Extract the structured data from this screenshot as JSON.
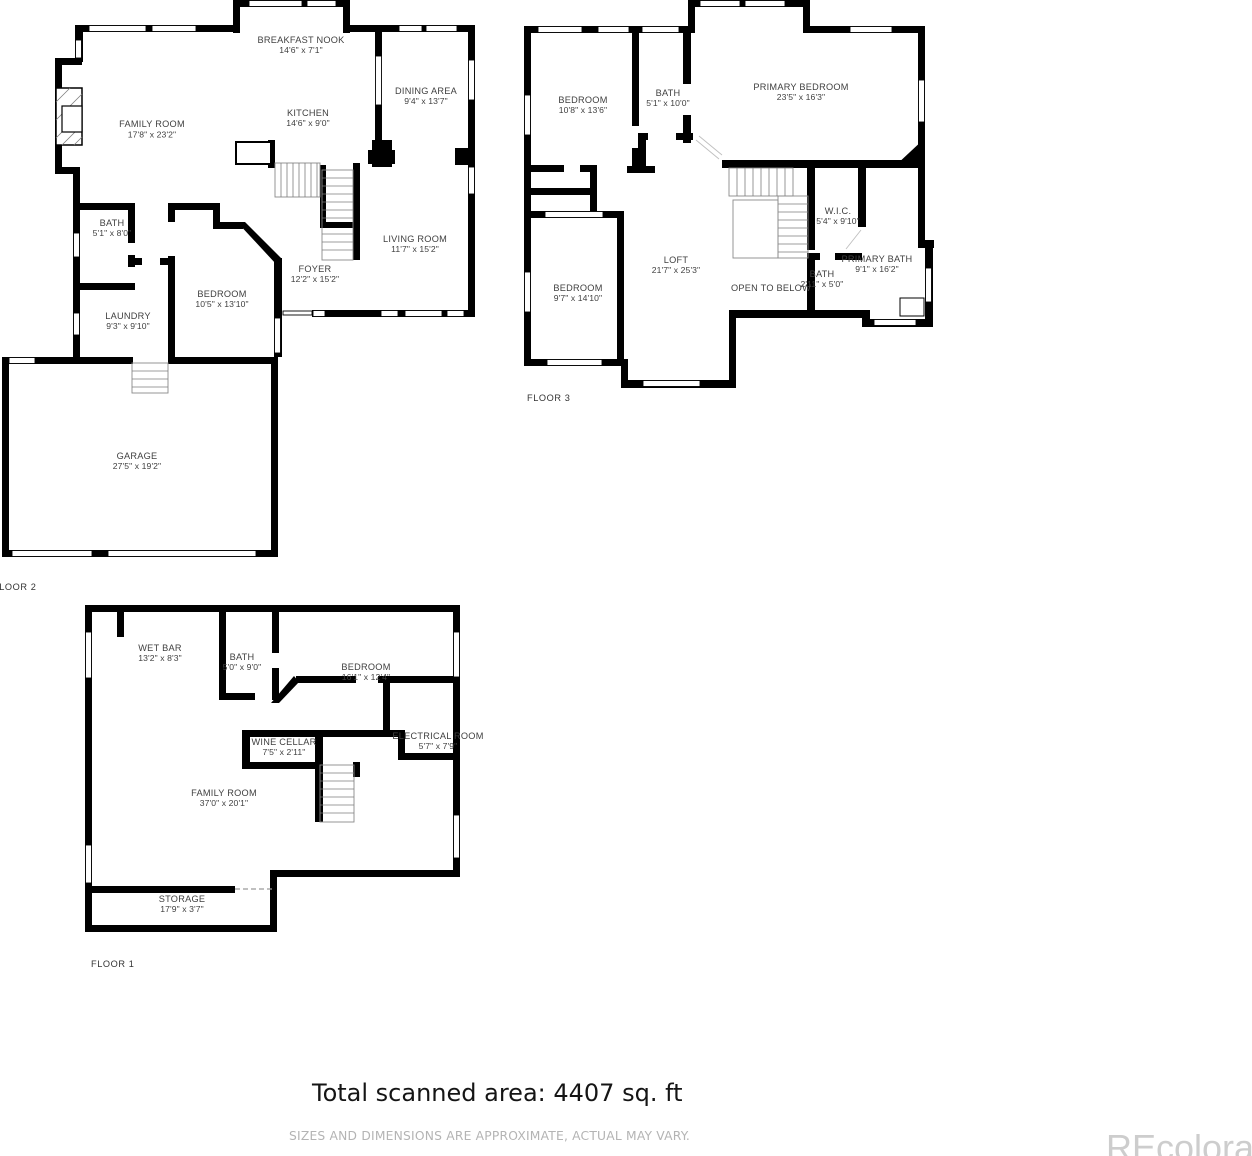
{
  "floors": [
    {
      "label": "FLOOR 2",
      "rooms": [
        {
          "name": "FAMILY ROOM",
          "dims": "17'8\" x 23'2\""
        },
        {
          "name": "BREAKFAST NOOK",
          "dims": "14'6\" x 7'1\""
        },
        {
          "name": "KITCHEN",
          "dims": "14'6\" x 9'0\""
        },
        {
          "name": "DINING AREA",
          "dims": "9'4\" x 13'7\""
        },
        {
          "name": "LIVING ROOM",
          "dims": "11'7\" x 15'2\""
        },
        {
          "name": "FOYER",
          "dims": "12'2\" x 15'2\""
        },
        {
          "name": "BEDROOM",
          "dims": "10'5\" x 13'10\""
        },
        {
          "name": "BATH",
          "dims": "5'1\" x 8'0\""
        },
        {
          "name": "LAUNDRY",
          "dims": "9'3\" x 9'10\""
        },
        {
          "name": "GARAGE",
          "dims": "27'5\" x 19'2\""
        }
      ]
    },
    {
      "label": "FLOOR 3",
      "rooms": [
        {
          "name": "BEDROOM",
          "dims": "10'8\" x 13'6\""
        },
        {
          "name": "BATH",
          "dims": "5'1\" x 10'0\""
        },
        {
          "name": "PRIMARY BEDROOM",
          "dims": "23'5\" x 16'3\""
        },
        {
          "name": "W.I.C.",
          "dims": "5'4\" x 9'10\""
        },
        {
          "name": "LOFT",
          "dims": "21'7\" x 25'3\""
        },
        {
          "name": "OPEN TO BELOW",
          "dims": ""
        },
        {
          "name": "BEDROOM",
          "dims": "9'7\" x 14'10\""
        },
        {
          "name": "BATH",
          "dims": "2'11\" x 5'0\""
        },
        {
          "name": "PRIMARY BATH",
          "dims": "9'1\" x 16'2\""
        }
      ]
    },
    {
      "label": "FLOOR 1",
      "rooms": [
        {
          "name": "WET BAR",
          "dims": "13'2\" x 8'3\""
        },
        {
          "name": "BATH",
          "dims": "5'0\" x 9'0\""
        },
        {
          "name": "BEDROOM",
          "dims": "16'1\" x 12'4\""
        },
        {
          "name": "WINE CELLAR",
          "dims": "7'5\" x 2'11\""
        },
        {
          "name": "ELECTRICAL ROOM",
          "dims": "5'7\" x 7'9\""
        },
        {
          "name": "FAMILY ROOM",
          "dims": "37'0\" x 20'1\""
        },
        {
          "name": "STORAGE",
          "dims": "17'9\" x 3'7\""
        }
      ]
    }
  ],
  "footer": {
    "total_area": "Total scanned area: 4407 sq. ft",
    "disclaimer": "SIZES AND DIMENSIONS ARE APPROXIMATE, ACTUAL MAY VARY."
  },
  "watermark": "REcolorado",
  "colors": {
    "wall": "#000000",
    "label": "#3f3f3f",
    "disclaimer": "#b4b4b4",
    "watermark": "#cdcdcd"
  }
}
